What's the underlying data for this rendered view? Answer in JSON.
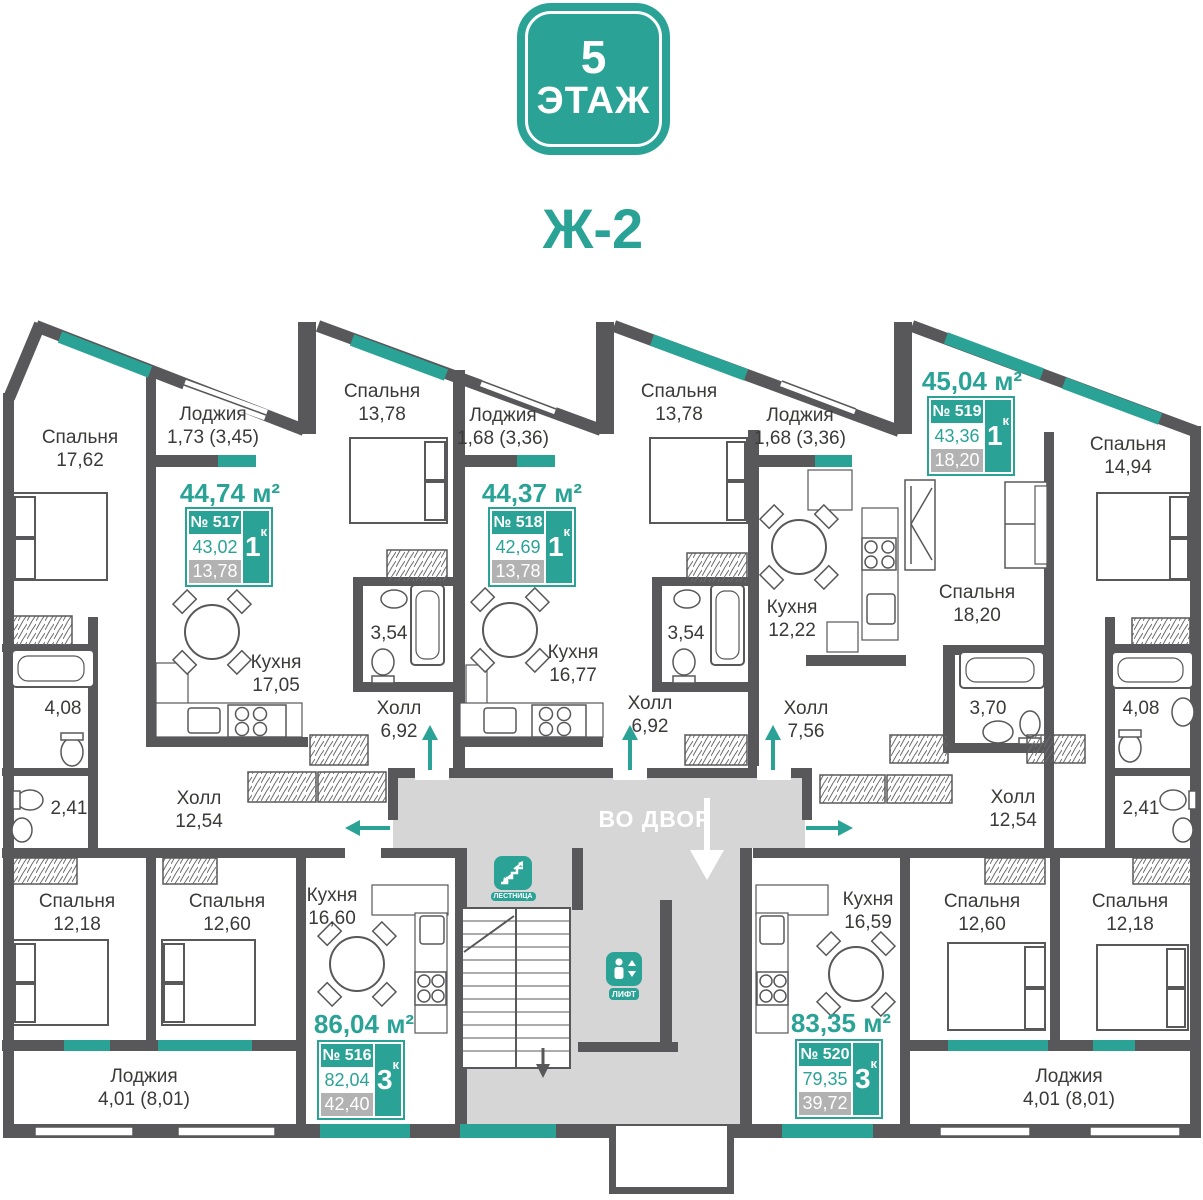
{
  "header": {
    "floor_number": "5",
    "floor_word": "ЭТАЖ",
    "building": "Ж-2"
  },
  "colors": {
    "accent": "#2AA396",
    "wall": "#58585A",
    "corridor": "#D5D6D5",
    "muted_fill": "#B2B2B2"
  },
  "corridor": {
    "to_yard": "ВО ДВОР",
    "elevator": "ЛИФТ",
    "stairs": "ЛЕСТНИЦА"
  },
  "apartments": [
    {
      "number": "№ 516",
      "title": "86,04 м²",
      "type_digit": "3",
      "type_letter": "к",
      "area_living": "82,04",
      "area_extra": "42,40"
    },
    {
      "number": "№ 517",
      "title": "44,74 м²",
      "type_digit": "1",
      "type_letter": "к",
      "area_living": "43,02",
      "area_extra": "13,78"
    },
    {
      "number": "№ 518",
      "title": "44,37 м²",
      "type_digit": "1",
      "type_letter": "к",
      "area_living": "42,69",
      "area_extra": "13,78"
    },
    {
      "number": "№ 519",
      "title": "45,04 м²",
      "type_digit": "1",
      "type_letter": "к",
      "area_living": "43,36",
      "area_extra": "18,20"
    },
    {
      "number": "№ 520",
      "title": "83,35 м²",
      "type_digit": "3",
      "type_letter": "к",
      "area_living": "79,35",
      "area_extra": "39,72"
    }
  ],
  "rooms": [
    {
      "name": "Спальня",
      "area": "17,62"
    },
    {
      "name": "Лоджия",
      "area": "1,73 (3,45)"
    },
    {
      "name": "Спальня",
      "area": "13,78"
    },
    {
      "name": "Лоджия",
      "area": "1,68 (3,36)"
    },
    {
      "name": "Спальня",
      "area": "13,78"
    },
    {
      "name": "Лоджия",
      "area": "1,68 (3,36)"
    },
    {
      "name": "Спальня",
      "area": "14,94"
    },
    {
      "name": "Кухня",
      "area": "17,05"
    },
    {
      "name": "Холл",
      "area": "6,92"
    },
    {
      "name": "",
      "area": "3,54"
    },
    {
      "name": "Кухня",
      "area": "16,77"
    },
    {
      "name": "Холл",
      "area": "6,92"
    },
    {
      "name": "",
      "area": "3,54"
    },
    {
      "name": "Кухня",
      "area": "12,22"
    },
    {
      "name": "Холл",
      "area": "7,56"
    },
    {
      "name": "Спальня",
      "area": "18,20"
    },
    {
      "name": "",
      "area": "3,70"
    },
    {
      "name": "Холл",
      "area": "12,54"
    },
    {
      "name": "Холл",
      "area": "12,54"
    },
    {
      "name": "",
      "area": "4,08"
    },
    {
      "name": "",
      "area": "2,41"
    },
    {
      "name": "",
      "area": "4,08"
    },
    {
      "name": "",
      "area": "2,41"
    },
    {
      "name": "Спальня",
      "area": "12,18"
    },
    {
      "name": "Спальня",
      "area": "12,60"
    },
    {
      "name": "Кухня",
      "area": "16,60"
    },
    {
      "name": "Кухня",
      "area": "16,59"
    },
    {
      "name": "Спальня",
      "area": "12,60"
    },
    {
      "name": "Спальня",
      "area": "12,18"
    },
    {
      "name": "Лоджия",
      "area": "4,01 (8,01)"
    },
    {
      "name": "Лоджия",
      "area": "4,01 (8,01)"
    }
  ]
}
